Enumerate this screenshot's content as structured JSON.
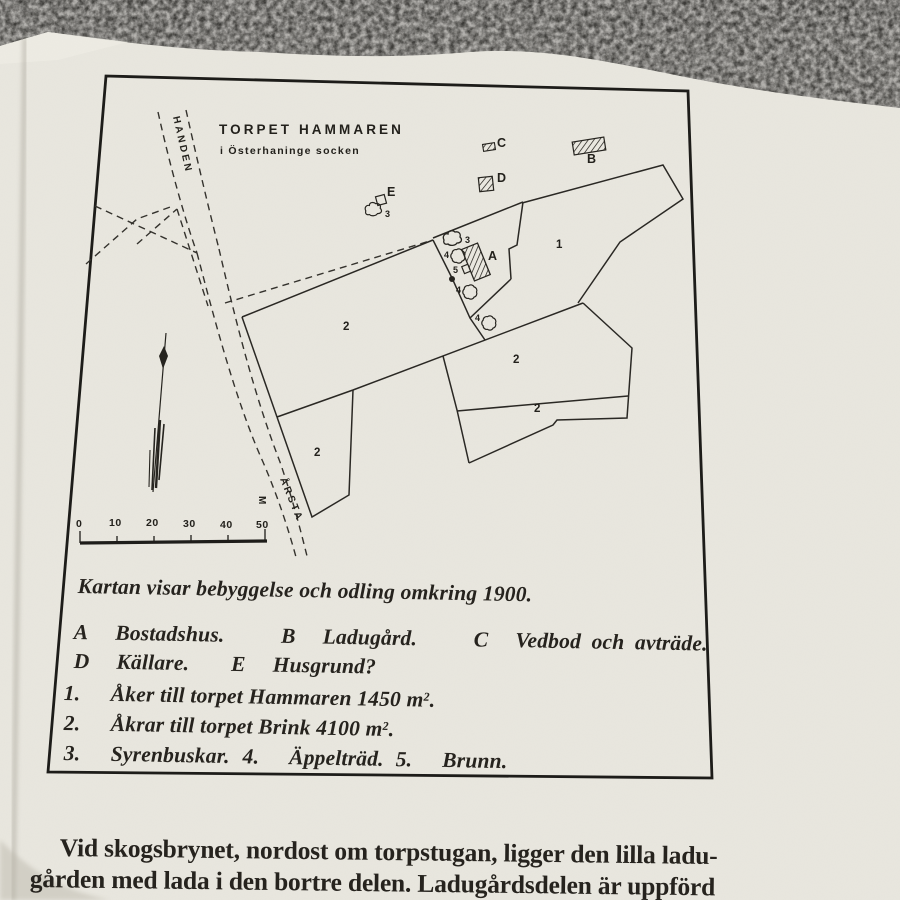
{
  "colors": {
    "carpet": "#42413d",
    "page": "#e9e7df",
    "ink": "#23211c"
  },
  "map": {
    "title": "TORPET HAMMAREN",
    "subtitle": "i Österhaninge socken",
    "labels": {
      "handen": "HANDEN",
      "arsta": "ÅRSTA",
      "meter": "M",
      "a": "A",
      "b": "B",
      "c": "C",
      "d": "D",
      "e": "E",
      "field1": "1",
      "field2": "2",
      "bush": "3",
      "tree": "4",
      "well": "5"
    },
    "scale": {
      "ticks": [
        "0",
        "10",
        "20",
        "30",
        "40",
        "50"
      ]
    }
  },
  "caption": {
    "intro": "Kartan visar bebyggelse och odling omkring 1900.",
    "buildings": [
      {
        "key": "A",
        "desc": "Bostadshus."
      },
      {
        "key": "B",
        "desc": "Ladugård."
      },
      {
        "key": "C",
        "desc": "Vedbod och avträde."
      },
      {
        "key": "D",
        "desc": "Källare."
      },
      {
        "key": "E",
        "desc": "Husgrund?"
      }
    ],
    "items": [
      {
        "num": "1.",
        "text": "Åker till torpet Hammaren 1450 m",
        "sup": "2",
        "tail": "."
      },
      {
        "num": "2.",
        "text": "Åkrar till torpet Brink 4100 m",
        "sup": "2",
        "tail": "."
      },
      {
        "num": "3.",
        "text": "Syrenbuskar."
      },
      {
        "num": "4.",
        "text": "Äppelträd."
      },
      {
        "num": "5.",
        "text": "Brunn."
      }
    ]
  },
  "body": {
    "line1": "Vid skogsbrynet, nordost om torpstugan, ligger den lilla ladu-",
    "line2": "gården med lada i den bortre delen. Ladugårdsdelen är uppförd"
  }
}
